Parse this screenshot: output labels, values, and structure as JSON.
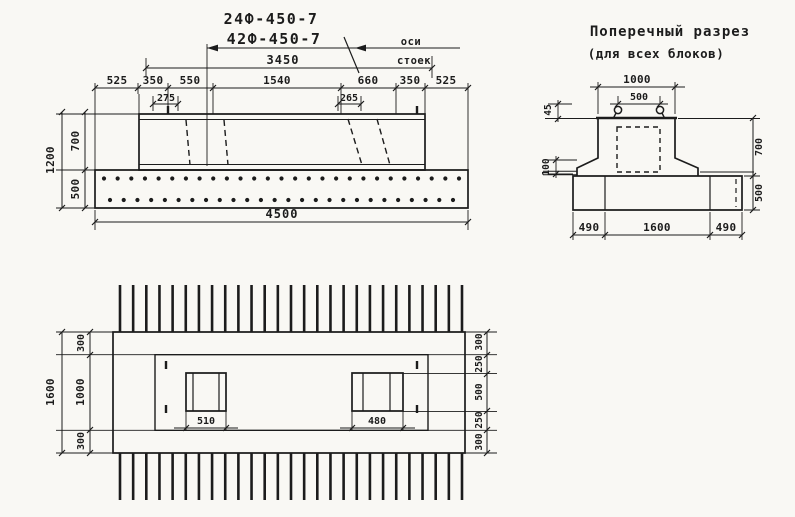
{
  "page": {
    "paper_color": "#f9f8f4",
    "ink_color": "#1c1c1c"
  },
  "elevation": {
    "titles": [
      "24Ф-450-7",
      "42Ф-450-7"
    ],
    "axes_label": [
      "оси",
      "стоек"
    ],
    "dim_beam_length": "3450",
    "top_dims": [
      "525",
      "350",
      "550",
      "1540",
      "660",
      "350",
      "525"
    ],
    "sub_dims": [
      "275",
      "265"
    ],
    "height_total": "1200",
    "height_upper": "700",
    "height_lower": "500",
    "dim_total_length": "4500",
    "rebar_dots_top": 27,
    "rebar_dots_bottom": 26
  },
  "section": {
    "title": [
      "Поперечный разрез",
      "(для всех блоков)"
    ],
    "dim_top_width": "1000",
    "dim_loop_spacing": "500",
    "dim_loop_recess": "45",
    "dim_shoulder": "100",
    "dim_height_upper": "700",
    "dim_height_lower": "500",
    "bottom_dims": [
      "490",
      "1600",
      "490"
    ]
  },
  "plan": {
    "dim_width_total": "1600",
    "left_dims": [
      "300",
      "1000",
      "300"
    ],
    "right_dims": [
      "300",
      "250",
      "500",
      "250",
      "300"
    ],
    "socket_dims": [
      "510",
      "480"
    ],
    "rebar_bars_top": 27,
    "rebar_bars_bottom": 27
  }
}
